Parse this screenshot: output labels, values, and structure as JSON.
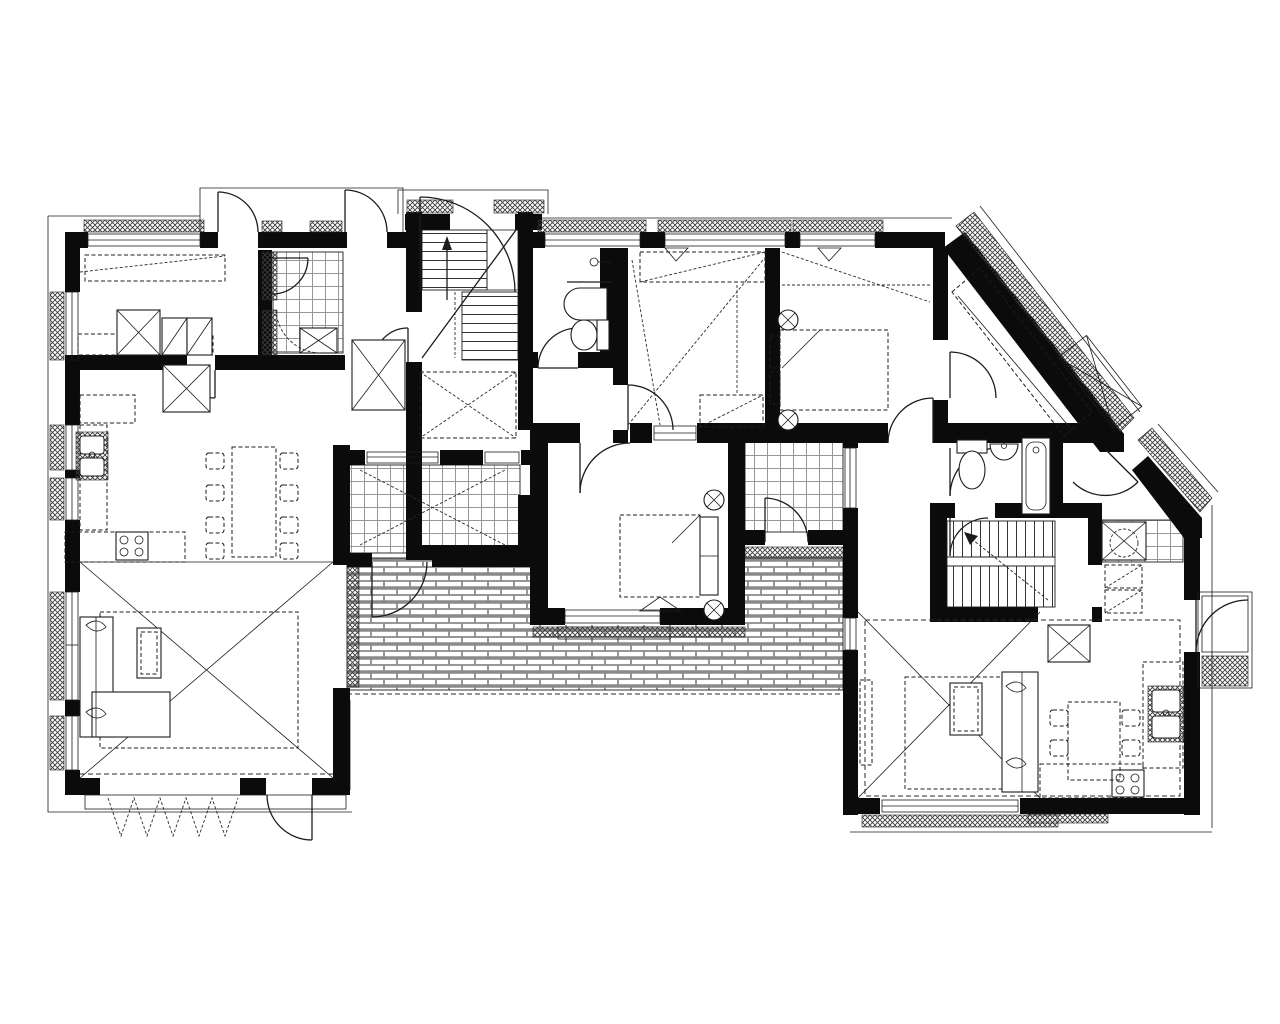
{
  "document": {
    "type": "architectural floor plan",
    "view": "top-down plan of an attic / upper storey containing two apartment units",
    "style": "monochrome CAD line drawing, no text labels visible",
    "visible_text": ""
  },
  "colors": {
    "background": "#ffffff",
    "wall": "#0b0b0b",
    "line": "#1c1c1c",
    "dash": "#2b2b2b",
    "hatch": "#3c3c3c",
    "tile": "#979797",
    "brick": "#8a8a8a"
  },
  "patterns": {
    "exterior_insulation": "dense diagonal crosshatch bands outside walls and at window sills",
    "bathroom_floor": "square tile grid",
    "terrace_floor": "running-bond brick paving",
    "stairs": "parallel tread lines with direction arrow",
    "ceiling_slope": "long dashed diagonal lines in attic rooms",
    "void_marker": "large thin X crossing living spaces"
  },
  "areas": {
    "left_apartment": {
      "rooms": [
        "bedroom top-left with wardrobes and sideboard",
        "tiled bathroom top-left with corner shower",
        "corridor with closet",
        "main staircase (two flights with landing)",
        "wc with washbasin and toilet",
        "open living room with double-height X marker",
        "kitchen along left wall (double sink, 4-burner stove, dashed counters)",
        "dining area with table and 8 chairs",
        "central bedroom with double bed and side bench",
        "tiled loggia / winter garden",
        "brick-paved terrace with roof-overhang dashed line",
        "top balcony with two outward-swinging doors"
      ]
    },
    "right_apartment": {
      "rooms": [
        "two north bedrooms (one with double bed and round stools)",
        "attic room behind long diagonal wall with under-slope wardrobe",
        "bathroom with toilet, washbasin and bathtub",
        "secondary staircase (two runs with centre rail)",
        "tiled shower corner with drain circle",
        "entrance vestibule with exterior porch on the east side",
        "living room with X void marker, sofa, rug and coffee table",
        "kitchen corner (double sink, 4-burner stove, dashed counters)",
        "dining area with table and 4 chairs"
      ]
    },
    "exterior": [
      "roof skylight marked as rotated X box outside the diagonal wall",
      "porch with hatched step at east entrance",
      "folding accordion door at lower-left terrace exit"
    ]
  },
  "fixtures_inventory": {
    "staircases": 2,
    "door_swings": 17,
    "windows": 16,
    "beds": 2,
    "sofas": 2,
    "dining_tables": 2,
    "chairs": 12,
    "toilets": 2,
    "washbasins": 3,
    "bathtubs": 1,
    "showers": 2,
    "kitchen_sinks": 2,
    "stoves": 2,
    "wardrobes_with_x": 6
  }
}
